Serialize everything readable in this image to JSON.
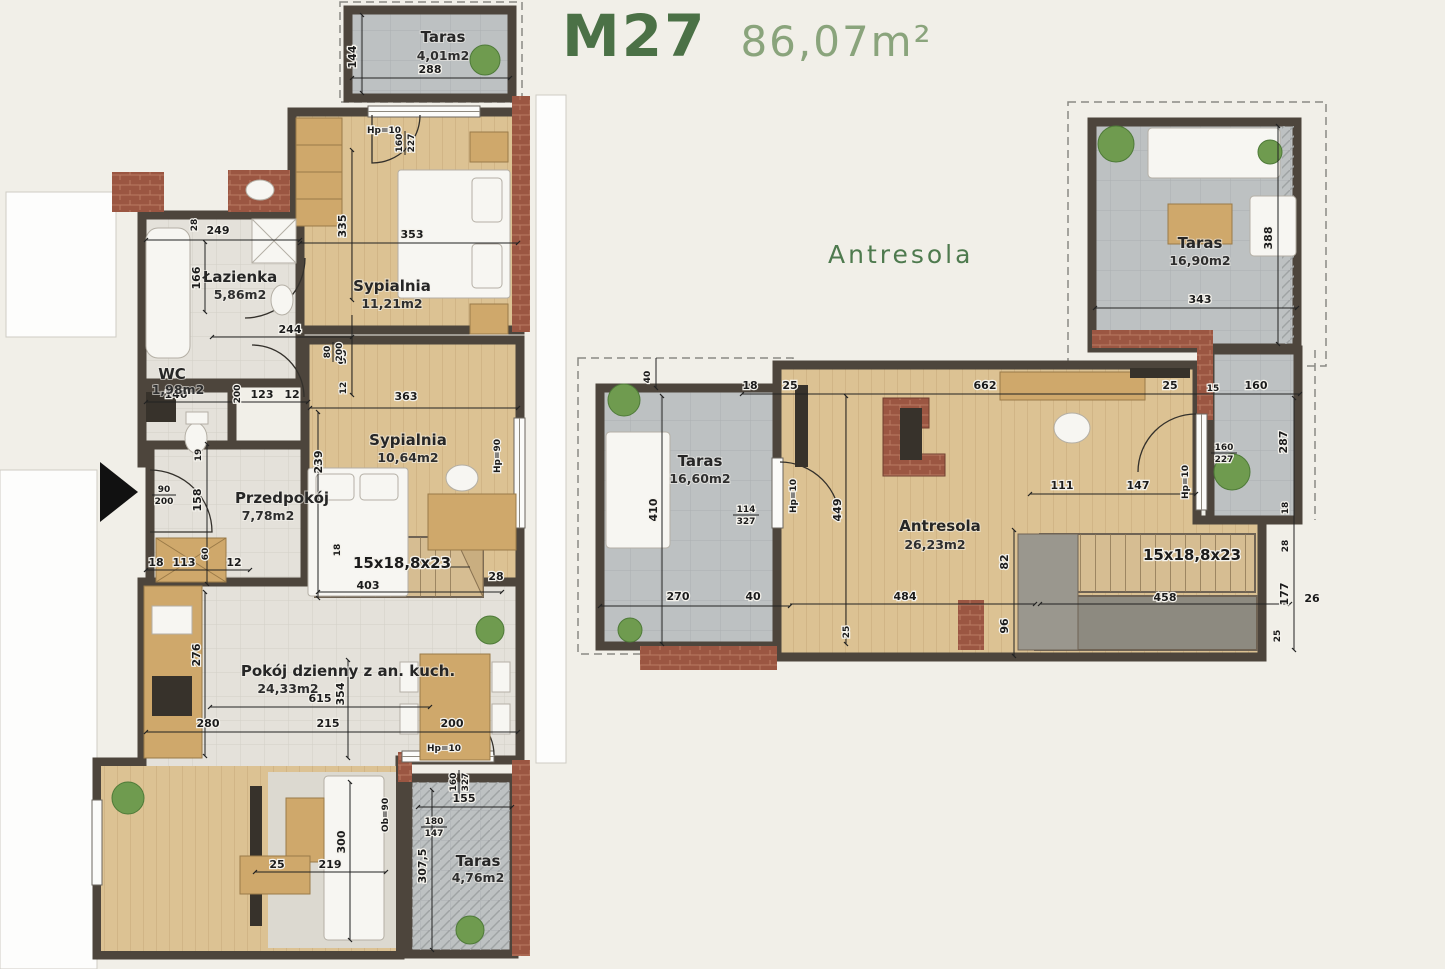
{
  "title": {
    "code": "M27",
    "area": "86,07m²"
  },
  "plans": {
    "main": {
      "rooms": [
        {
          "name": "Taras",
          "area": "4,01m2"
        },
        {
          "name": "Łazienka",
          "area": "5,86m2"
        },
        {
          "name": "Sypialnia",
          "area": "11,21m2"
        },
        {
          "name": "WC",
          "area": "1,98m2"
        },
        {
          "name": "Sypialnia",
          "area": "10,64m2"
        },
        {
          "name": "Przedpokój",
          "area": "7,78m2"
        },
        {
          "name": "Pokój dzienny z an. kuch.",
          "area": "24,33m2"
        },
        {
          "name": "Taras",
          "area": "4,76m2"
        }
      ],
      "dims": [
        "144",
        "288",
        "249",
        "28",
        "166",
        "335",
        "353",
        "Hp=10",
        "160",
        "227",
        "244",
        "95",
        "12",
        "80",
        "200",
        "140",
        "123",
        "12",
        "200",
        "19",
        "158",
        "90",
        "200",
        "18",
        "113",
        "60",
        "12",
        "363",
        "239",
        "Hp=90",
        "15x18,8x23",
        "403",
        "28",
        "18",
        "276",
        "615",
        "354",
        "280",
        "215",
        "200",
        "Hp=10",
        "25",
        "219",
        "300",
        "Ob=90",
        "160",
        "327",
        "155",
        "180",
        "147",
        "307,5"
      ]
    },
    "upper": {
      "title": "Antresola",
      "rooms": [
        {
          "name": "Taras",
          "area": "16,90m2"
        },
        {
          "name": "Taras",
          "area": "16,60m2"
        },
        {
          "name": "Antresola",
          "area": "26,23m2"
        }
      ],
      "dims": [
        "343",
        "388",
        "40",
        "18",
        "25",
        "662",
        "25",
        "15",
        "160",
        "287",
        "18",
        "28",
        "177",
        "26",
        "410",
        "114",
        "327",
        "Hp=10",
        "449",
        "111",
        "147",
        "82",
        "15x18,8x23",
        "458",
        "96",
        "270",
        "40",
        "484",
        "25",
        "160",
        "227",
        "Hp=10",
        "25"
      ]
    }
  },
  "colors": {
    "accent_green": "#4b7146",
    "area_green": "#8aa47c",
    "wall": "#4d453c",
    "wood_floor": "#dcc293",
    "tile_floor": "#e4e1da",
    "terrace": "#bdc1c2",
    "brick": "#9b5642"
  }
}
